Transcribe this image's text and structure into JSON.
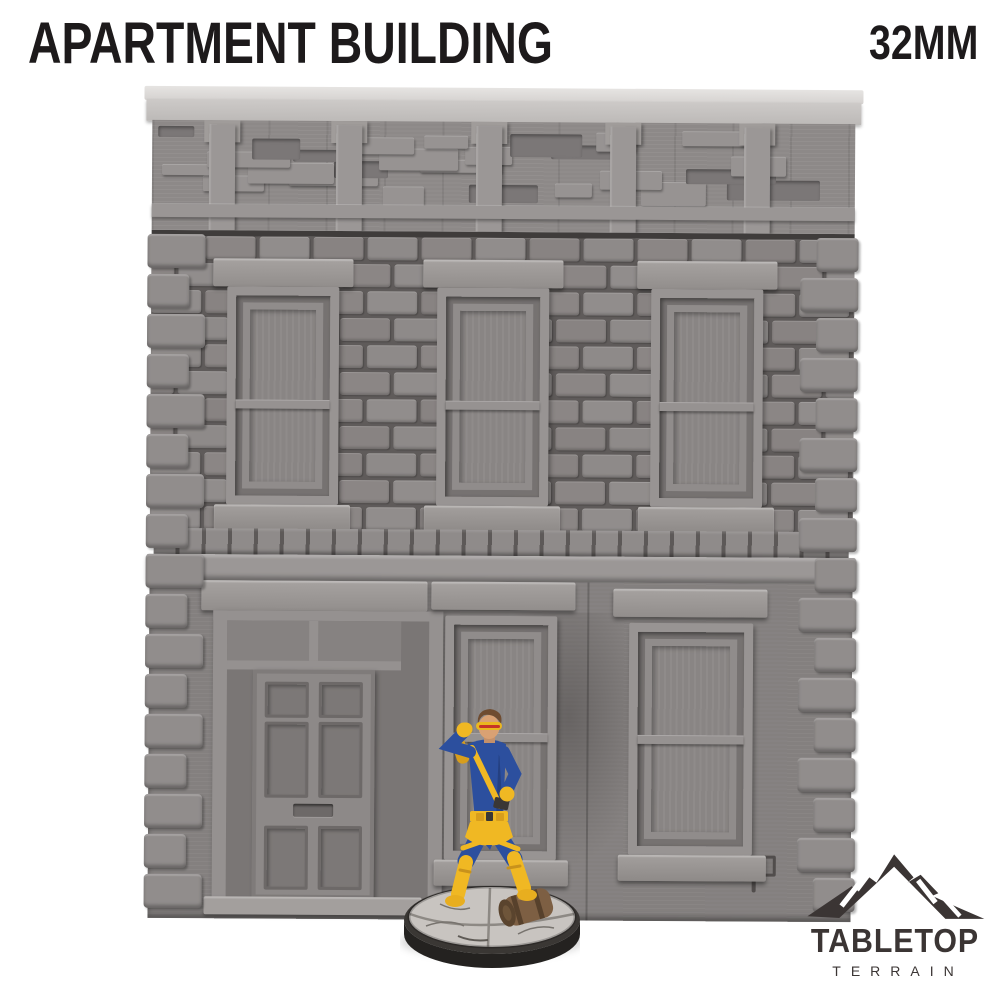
{
  "header": {
    "title": "APARTMENT BUILDING",
    "scale_label": "32MM",
    "text_color": "#1d1a1b"
  },
  "brand": {
    "name_line1": "TABLETOP",
    "name_line2": "TERRAIN",
    "color": "#3b3534",
    "icon": "mountain-logo-icon"
  },
  "scene": {
    "background_color": "#ffffff",
    "subject": "grey 3D-printed two-story apartment building terrain piece",
    "building": {
      "primary_color": "#8a8685",
      "roof_cap_color": "#cbc8c6",
      "mortar_color": "#5f5b5a",
      "upper_floor_windows": 3,
      "ground_floor_windows": 2,
      "doors": 1
    },
    "miniature": {
      "subject": "32mm painted superhero miniature with visor standing on round cobblestone base",
      "suit_color": "#2c4f9e",
      "accent_color": "#f0b823",
      "visor_slit_color": "#c63427",
      "skin_color": "#d9a173",
      "hair_color": "#6f4c30",
      "base_top_color": "#c8c4c0",
      "base_rim_color": "#242220",
      "barrel_color": "#7d5f43"
    }
  }
}
